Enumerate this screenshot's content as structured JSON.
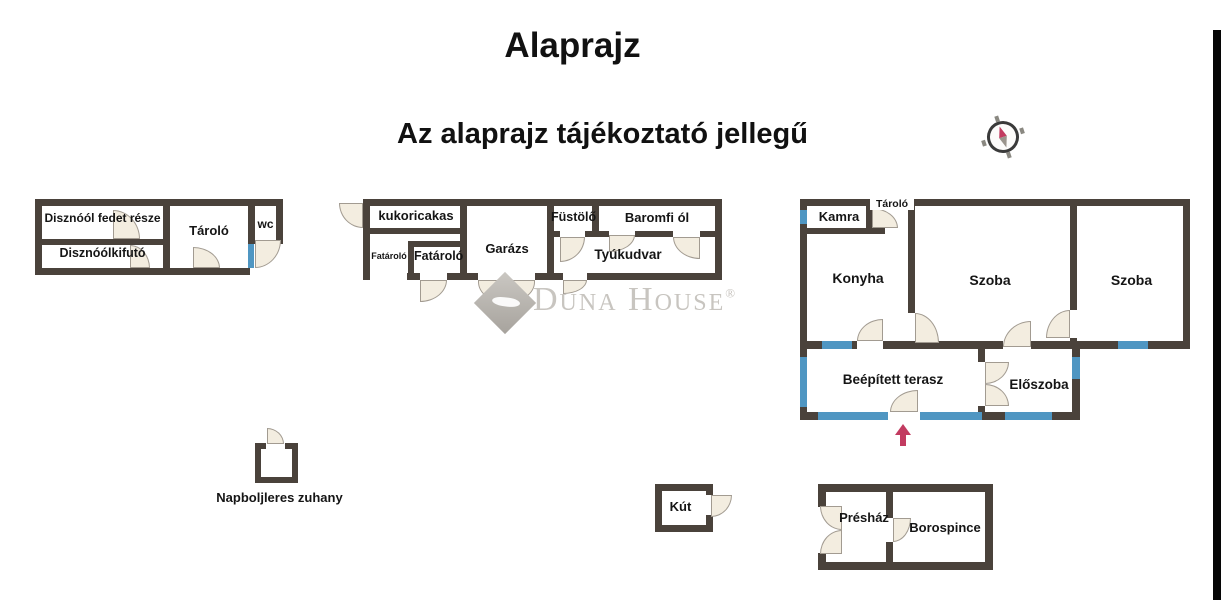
{
  "titles": {
    "main": "Alaprajz",
    "note": "Az alaprajz tájékoztató jellegű"
  },
  "watermark": {
    "brand": "Duna House",
    "reg": "®"
  },
  "pigsty": {
    "covered": "Disznóól fedet része",
    "run": "Disznóólkifutó",
    "storage": "Tároló",
    "wc": "wc"
  },
  "farm": {
    "corn_crib": "kukoricakas",
    "wood_small": "Fatároló",
    "wood": "Fatároló",
    "garage": "Garázs",
    "smoker": "Füstölő",
    "poultry": "Baromfi ól",
    "yard": "Tyúkudvar"
  },
  "house": {
    "pantry": "Kamra",
    "storage": "Tároló",
    "kitchen": "Konyha",
    "room_center": "Szoba",
    "room_right": "Szoba",
    "terrace": "Beépített terasz",
    "hall": "Előszoba"
  },
  "well": {
    "label": "Kút"
  },
  "press": {
    "house": "Présház",
    "cellar": "Borospince"
  },
  "shower": {
    "label": "Napboljleres zuhany"
  },
  "colors": {
    "wall": "#4a423b",
    "window": "#4f96c2",
    "door": "#f3ede0",
    "door_edge": "#a29b91",
    "arrow": "#c23b60",
    "watermark": "#c8c5c0"
  }
}
